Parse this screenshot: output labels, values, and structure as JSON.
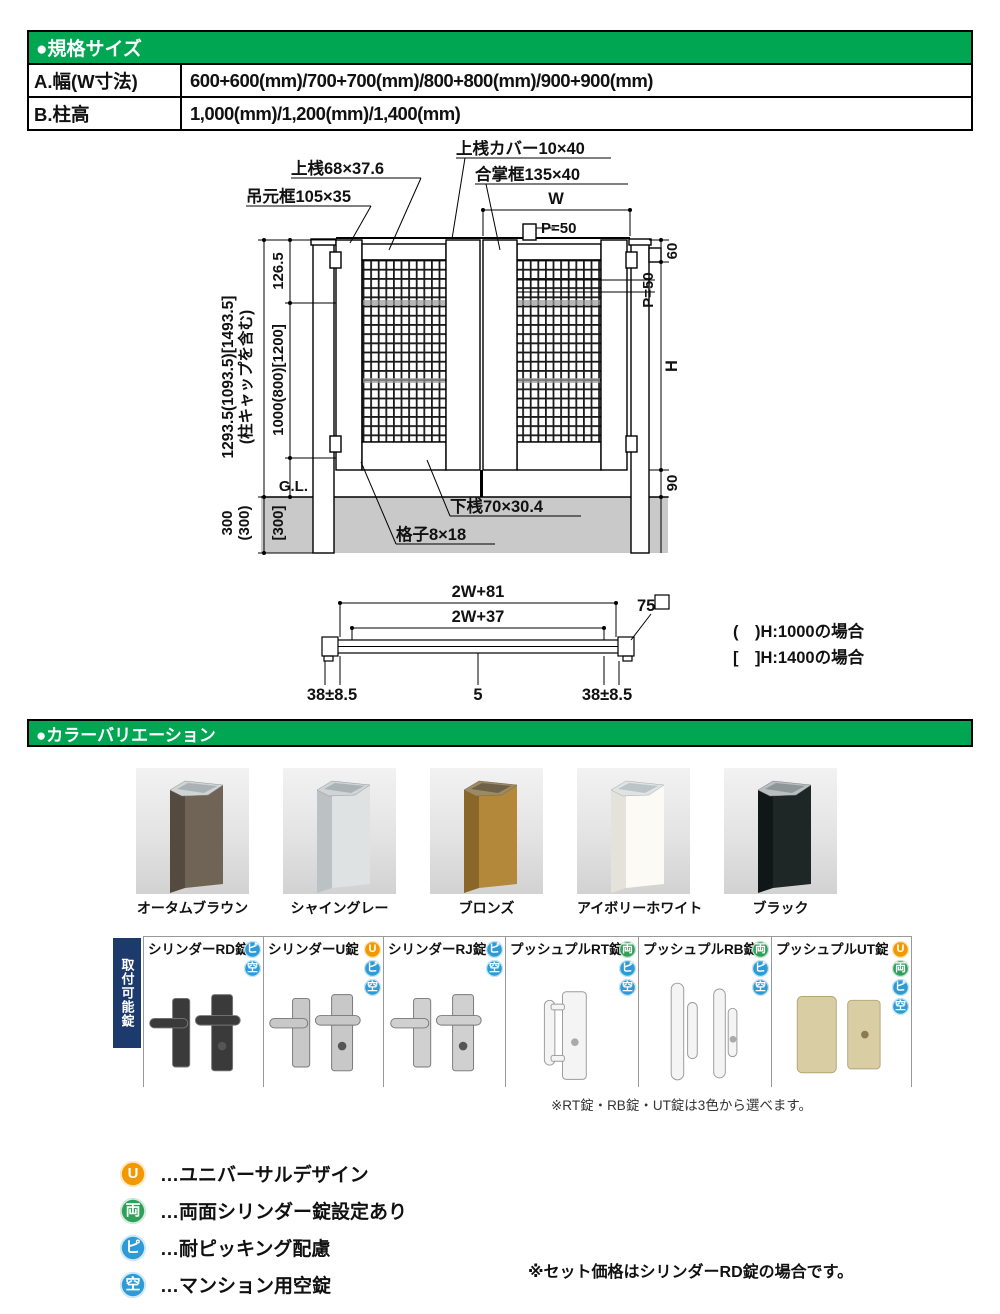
{
  "spec_table": {
    "title": "●規格サイズ",
    "rows": [
      {
        "label": "A.幅(W寸法)",
        "value": "600+600(mm)/700+700(mm)/800+800(mm)/900+900(mm)"
      },
      {
        "label": "B.柱高",
        "value": "1,000(mm)/1,200(mm)/1,400(mm)"
      }
    ]
  },
  "diagram": {
    "top_rail": "上桟68×37.6",
    "top_cover": "上桟カバー10×40",
    "meeting_stile": "合掌框135×40",
    "hanging_stile": "吊元框105×35",
    "w": "W",
    "p_top": "P=50",
    "total_h_line1": "1293.5(1093.5)[1493.5]",
    "total_h_line2": "(柱キャップを含む)",
    "d126": "126.5",
    "panel_h": "1000(800)[1200]",
    "gl": "G.L.",
    "embed_a": "300",
    "embed_b": "(300)",
    "embed_c": "[300]",
    "bottom_rail": "下桟70×30.4",
    "lattice": "格子8×18",
    "d60": "60",
    "p_right": "P=50",
    "h": "H",
    "d90": "90",
    "plan_w81": "2W+81",
    "plan_w37": "2W+37",
    "d75": "75",
    "d38l": "38±8.5",
    "d5": "5",
    "d38r": "38±8.5",
    "note_h1000": "(　)H:1000の場合",
    "note_h1400": "[　]H:1400の場合"
  },
  "color_section": {
    "title": "●カラーバリエーション",
    "colors": [
      {
        "name": "オータムブラウン",
        "front": "#6f6456",
        "side": "#554a3f"
      },
      {
        "name": "シャイングレー",
        "front": "#dfe2e2",
        "side": "#bcc1c3"
      },
      {
        "name": "ブロンズ",
        "front": "#b3883b",
        "side": "#8a6628"
      },
      {
        "name": "アイボリーホワイト",
        "front": "#fbfaf5",
        "side": "#e5e2d9"
      },
      {
        "name": "ブラック",
        "front": "#1e2725",
        "side": "#101716"
      }
    ]
  },
  "badges": {
    "universal": {
      "char": "U",
      "color": "#f39800"
    },
    "double": {
      "char": "両",
      "color": "#2fa05a"
    },
    "pick": {
      "char": "ピ",
      "color": "#2e9bd6"
    },
    "vacant": {
      "char": "空",
      "color": "#2e9bd6"
    }
  },
  "locks": {
    "side_label": "取付可能錠",
    "note": "※RT錠・RB錠・UT錠は3色から選べます。",
    "items": [
      {
        "name": "シリンダーRD錠",
        "color": "#3a3a3a"
      },
      {
        "name": "シリンダーU錠",
        "color": "#c8c8c8"
      },
      {
        "name": "シリンダーRJ錠",
        "color": "#d0d0d0"
      },
      {
        "name": "プッシュプルRT錠",
        "color": "#f4f4f4"
      },
      {
        "name": "プッシュプルRB錠",
        "color": "#f4f4f4"
      },
      {
        "name": "プッシュプルUT錠",
        "color": "#d9cda4"
      }
    ]
  },
  "legend": {
    "items": [
      {
        "text": "…ユニバーサルデザイン"
      },
      {
        "text": "…両面シリンダー錠設定あり"
      },
      {
        "text": "…耐ピッキング配慮"
      },
      {
        "text": "…マンション用空錠"
      }
    ],
    "note": "※セット価格はシリンダーRD錠の場合です。"
  }
}
